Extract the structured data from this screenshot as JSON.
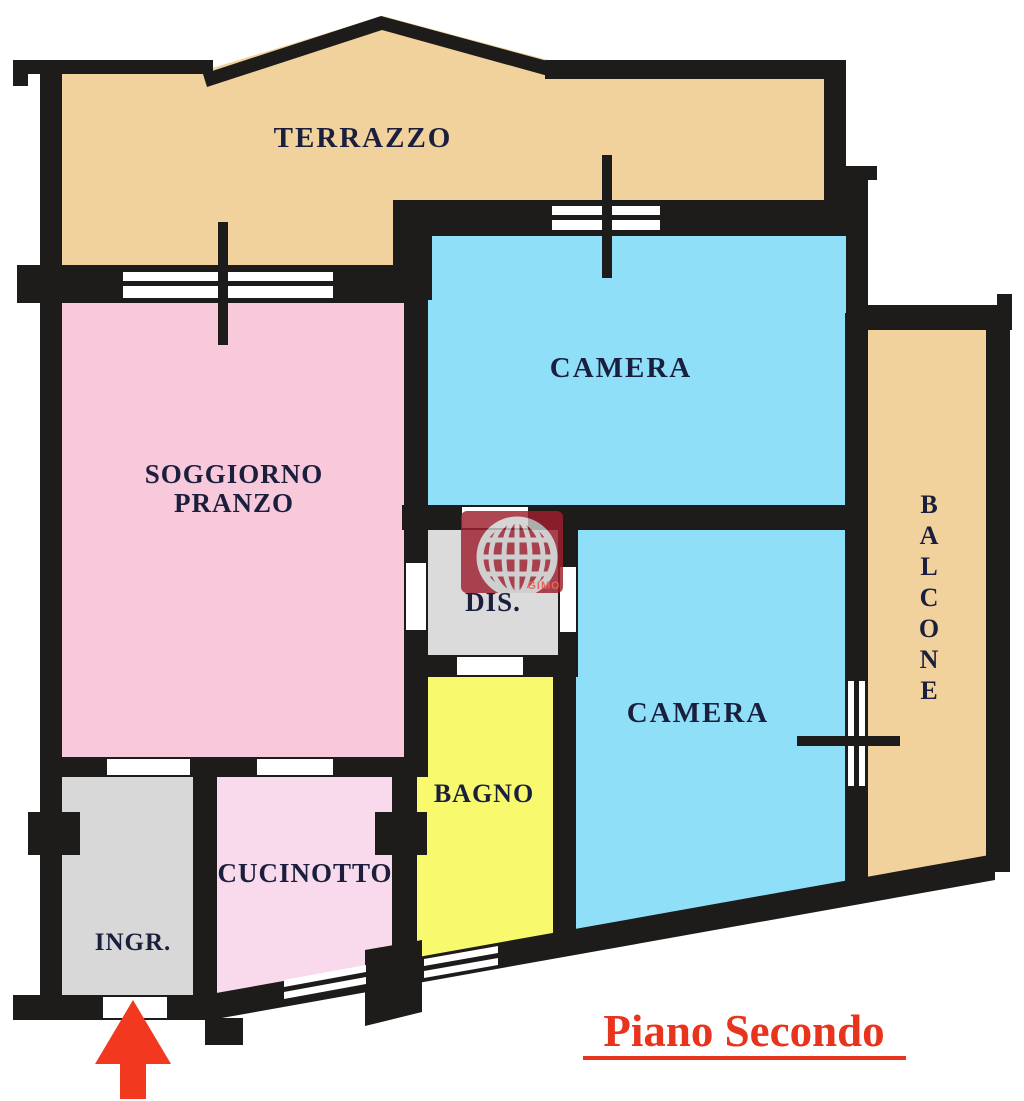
{
  "plan": {
    "title": "Piano Secondo",
    "rooms": {
      "terrazzo": {
        "label": "TERRAZZO",
        "color": "#F2D29C"
      },
      "soggiorno_pranzo": {
        "label_line1": "SOGGIORNO",
        "label_line2": "PRANZO",
        "color": "#F8C8DB"
      },
      "camera_1": {
        "label": "CAMERA",
        "color": "#8FDFF8"
      },
      "camera_2": {
        "label": "CAMERA",
        "color": "#8FDFF8"
      },
      "disimpegno": {
        "label": "DIS.",
        "color": "#DBDBDB"
      },
      "bagno": {
        "label": "BAGNO",
        "color": "#F9F96E"
      },
      "cucinotto": {
        "label": "CUCINOTTO",
        "color": "#F9DAEC"
      },
      "ingresso": {
        "label": "INGR.",
        "color": "#D8D8D8"
      },
      "balcone": {
        "letters": [
          "B",
          "A",
          "L",
          "C",
          "O",
          "N",
          "E"
        ],
        "color": "#F2D29C"
      }
    },
    "watermark": {
      "text": "GIMO"
    },
    "colors": {
      "wall": "#1E1C1A",
      "opening": "#FFFFFF",
      "label": "#1B1F3E",
      "title": "#E8331D",
      "arrow": "#F23920",
      "watermark_bg": "#9E1F2E",
      "watermark_fg": "#CDCDCD",
      "watermark_text": "#E65040",
      "background": "#FFFFFF"
    }
  }
}
